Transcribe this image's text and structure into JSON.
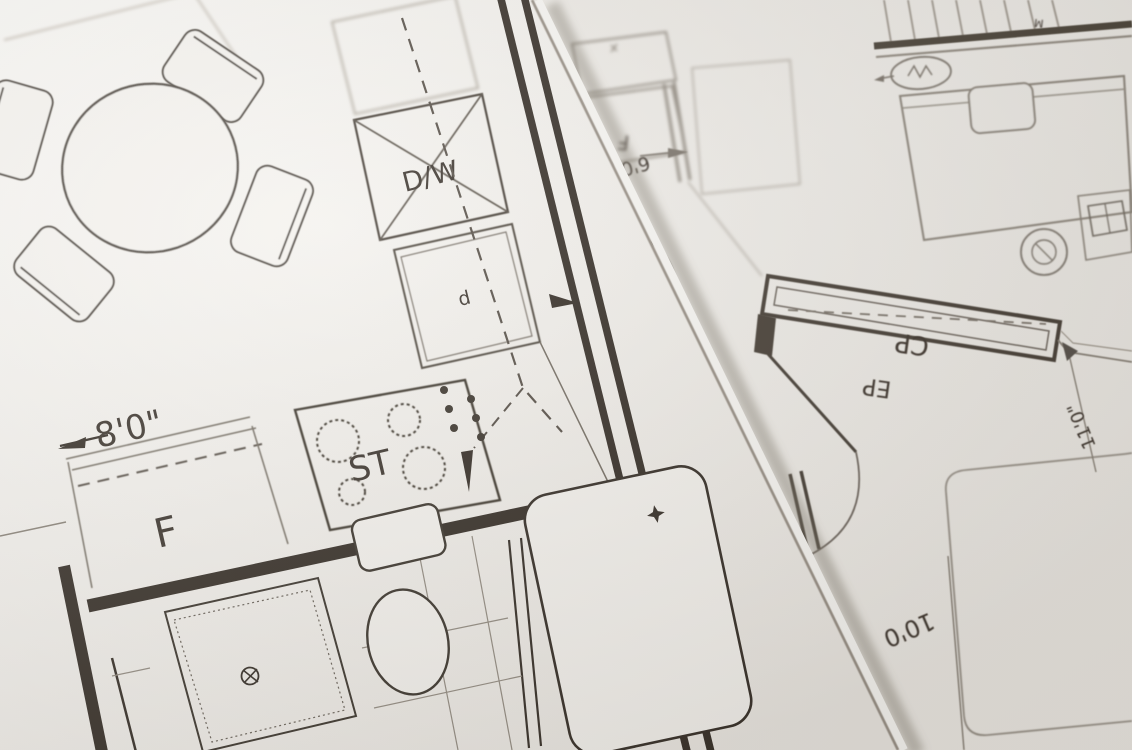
{
  "scene": {
    "description": "Photograph of two overlapping architectural floor plan drawings on paper",
    "colors": {
      "paper_left": "#f7f5f1",
      "paper_right": "#f2efeb",
      "ink_dark": "#332c25",
      "ink_medium": "#5a534b",
      "ink_faint": "#9a938a",
      "edge_shadow": "#8c8densional"
    }
  },
  "left_sheet": {
    "labels": {
      "dishwasher": "D/W",
      "appliance_d": "d",
      "dimension_8ft": "8'0\"",
      "fridge": "F",
      "stove": "ST"
    }
  },
  "right_sheet": {
    "labels": {
      "cupboard": "CP",
      "ep": "EP",
      "dimension_11ft": "11'0\"",
      "dimension_10ft": "10'0",
      "dimension_6ft": "6'0",
      "fridge_flipped": "F",
      "marker_m": "M"
    }
  },
  "symbols": {
    "shower_drain": "circled cross drain",
    "tub_drain": "four point star",
    "fan_oval": "oval with zigzag"
  }
}
